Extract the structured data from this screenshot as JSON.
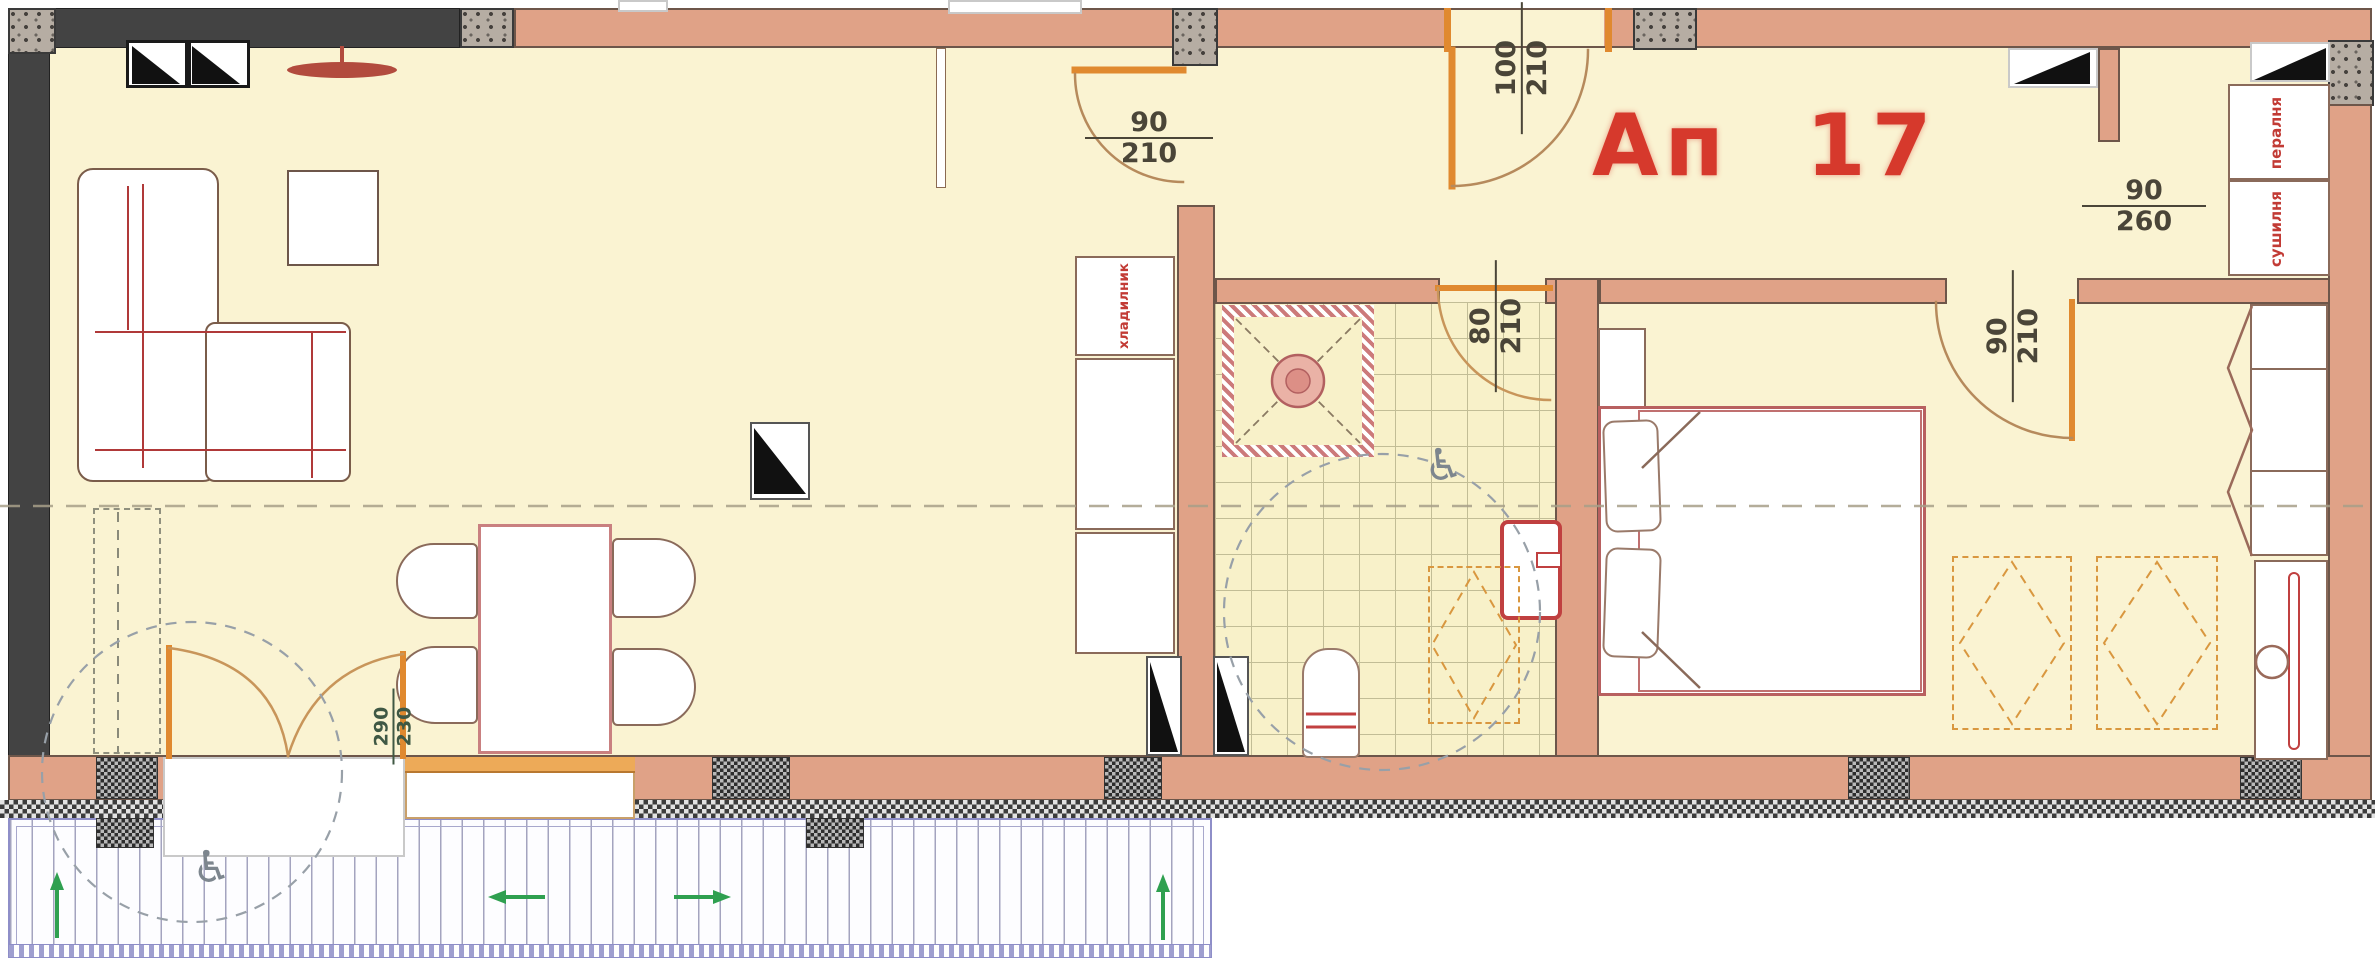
{
  "apartment": {
    "label": "Ап 17"
  },
  "dimensions": {
    "living_room_door": {
      "width": "90",
      "height": "210"
    },
    "entrance_door": {
      "width": "100",
      "height": "210"
    },
    "bathroom_door": {
      "width": "80",
      "height": "210"
    },
    "bedroom_door": {
      "width": "90",
      "height": "210"
    },
    "utility_window": {
      "width": "90",
      "height": "260"
    },
    "balcony_door": {
      "width": "290",
      "height": "230"
    }
  },
  "appliances": {
    "washing_machine": "пералня",
    "dryer": "сушилня",
    "refrigerator": "хладилник"
  },
  "icons": {
    "wheelchair": "♿"
  },
  "colors": {
    "apartment_label": "#d6392c",
    "walls": "#e0a287",
    "floor": "#faf3d2",
    "doors": "#e0892f",
    "dimension_text": "#4a4538",
    "appliance_text": "#c23b35",
    "direction_arrows": "#2fa050"
  }
}
